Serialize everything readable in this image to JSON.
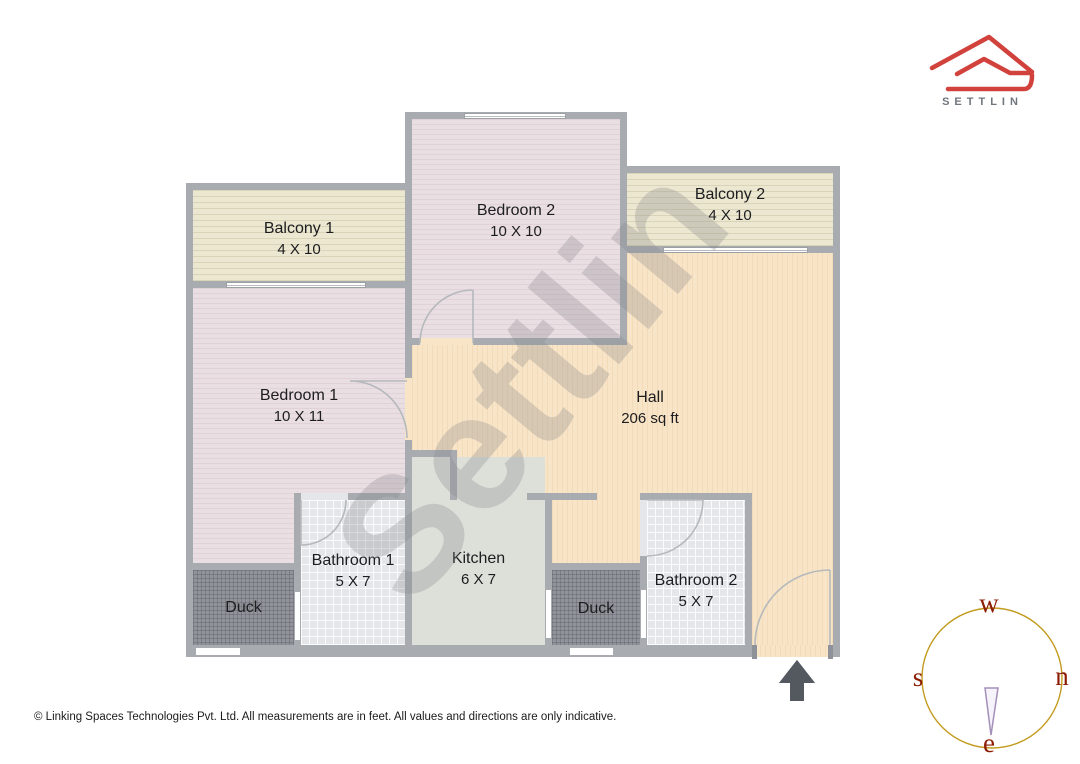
{
  "brand": {
    "name": "SETTLIN"
  },
  "watermark_text": "Settlin",
  "rooms": {
    "balcony1": {
      "name": "Balcony 1",
      "dims": "4 X 10"
    },
    "bedroom2": {
      "name": "Bedroom 2",
      "dims": "10 X 10"
    },
    "balcony2": {
      "name": "Balcony 2",
      "dims": "4 X 10"
    },
    "bedroom1": {
      "name": "Bedroom 1",
      "dims": "10 X 11"
    },
    "hall": {
      "name": "Hall",
      "dims": "206 sq ft"
    },
    "kitchen": {
      "name": "Kitchen",
      "dims": "6 X 7"
    },
    "bathroom1": {
      "name": "Bathroom 1",
      "dims": "5 X 7"
    },
    "bathroom2": {
      "name": "Bathroom 2",
      "dims": "5 X 7"
    },
    "duck_left": {
      "name": "Duck"
    },
    "duck_right": {
      "name": "Duck"
    }
  },
  "compass": {
    "top": "w",
    "left": "s",
    "right": "n",
    "bottom": "e"
  },
  "footer": {
    "copyright": "© Linking Spaces Technologies Pvt. Ltd. All measurements are in feet. All values and directions are only indicative."
  },
  "icons": {
    "entrance_arrow": "triangle-up",
    "logo": "settlin-roof-outline"
  },
  "colors": {
    "brand_red": "#d2423d",
    "wall_gray": "#a8acb0",
    "hall_floor": "#f8e4c7",
    "bedroom_floor": "#e9dee2",
    "balcony_floor": "#ebe7d1",
    "bathroom_floor": "#e4e6e9",
    "kitchen_floor": "#dce0d9",
    "duct_floor": "#90949a",
    "compass_ring": "#c39b1e",
    "compass_letters": "#8c1c03",
    "needle_outline": "#a48fb9",
    "entry_arrow": "#545960"
  }
}
